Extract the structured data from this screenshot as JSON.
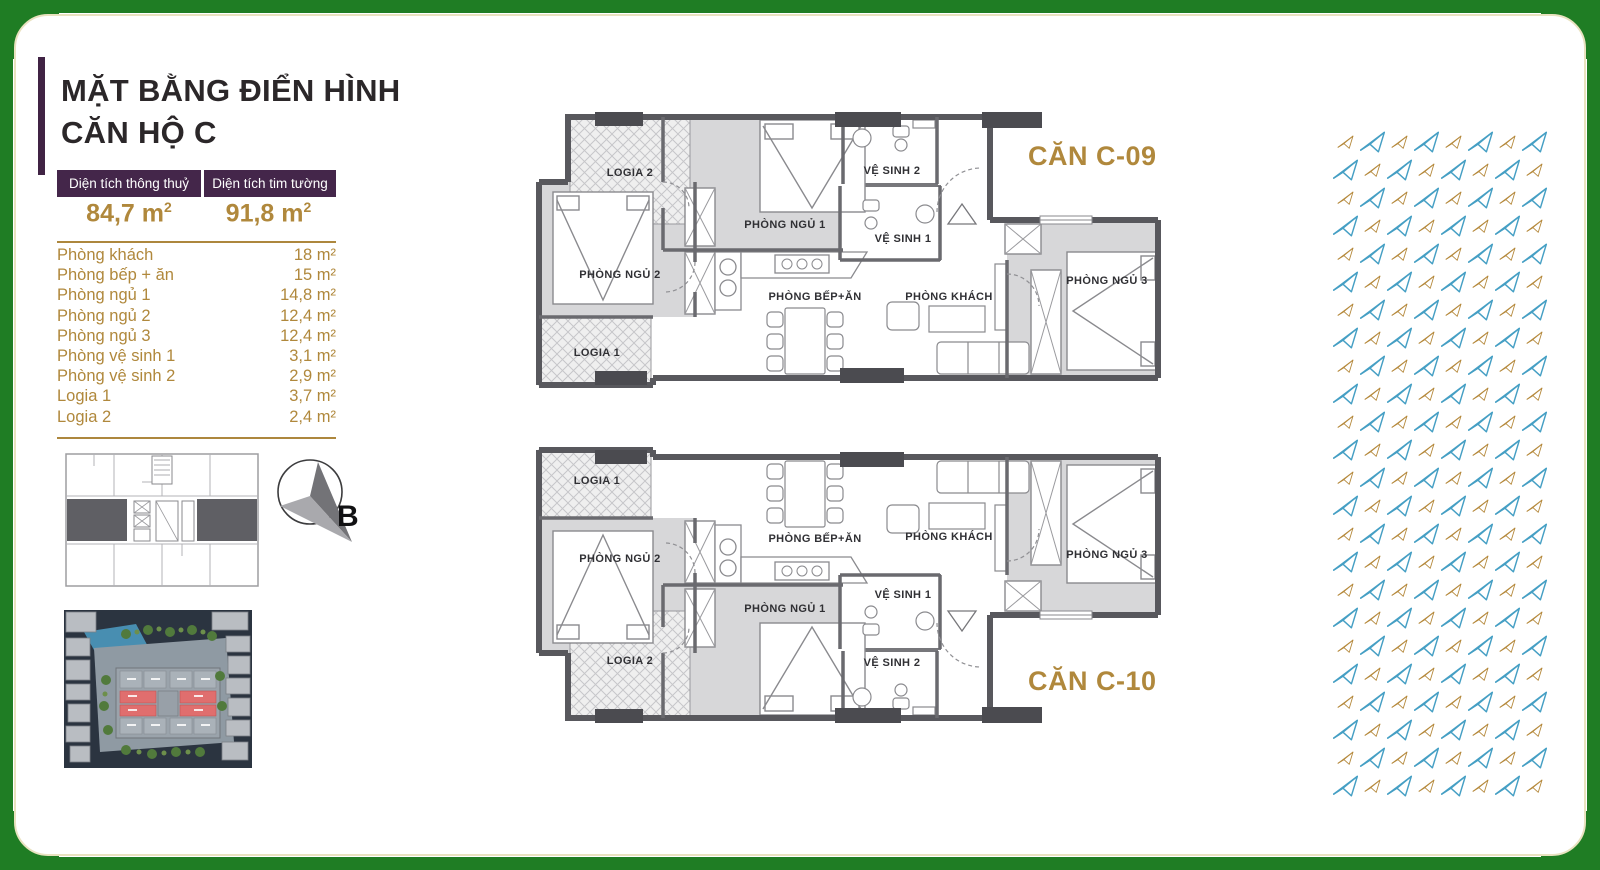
{
  "page": {
    "kind": "apartment floor plan brochure"
  },
  "colors": {
    "frame_green": "#1f7d24",
    "frame_cream": "#e9e2c0",
    "brand_purple": "#44264a",
    "brand_gold": "#b0883c",
    "plane_blue": "#459fc4",
    "plane_gold": "#b5893c",
    "highlight_red": "#e06e6e"
  },
  "sidebar": {
    "title_line1": "MẶT BẰNG ĐIỂN HÌNH",
    "title_line2": "CĂN HỘ C",
    "table": {
      "col1_header": "Diện tích thông thuỷ",
      "col2_header": "Diện tích tim tường",
      "col1_value": "84,7 m",
      "col1_sup": "2",
      "col2_value": "91,8 m",
      "col2_sup": "2"
    },
    "rooms": [
      {
        "name": "Phòng khách",
        "area": "18 m²"
      },
      {
        "name": "Phòng bếp + ăn",
        "area": "15 m²"
      },
      {
        "name": "Phòng ngủ 1",
        "area": "14,8 m²"
      },
      {
        "name": "Phòng ngủ 2",
        "area": "12,4 m²"
      },
      {
        "name": "Phòng ngủ 3",
        "area": "12,4 m²"
      },
      {
        "name": "Phòng vệ sinh 1",
        "area": "3,1 m²"
      },
      {
        "name": "Phòng vệ sinh 2",
        "area": "2,9 m²"
      },
      {
        "name": "Logia 1",
        "area": "3,7 m²"
      },
      {
        "name": "Logia 2",
        "area": "2,4 m²"
      }
    ]
  },
  "compass": {
    "label": "B"
  },
  "plans": {
    "c09": {
      "title": "CĂN C-09",
      "labels": {
        "logia2": "LOGIA 2",
        "bedroom1": "PHÒNG NGỦ 1",
        "bath2": "VỆ SINH 2",
        "bath1": "VỆ SINH 1",
        "bedroom2": "PHÒNG NGỦ 2",
        "logia1": "LOGIA 1",
        "kitchen": "PHÒNG BẾP+ĂN",
        "living": "PHÒNG KHÁCH",
        "bedroom3": "PHÒNG NGỦ 3"
      }
    },
    "c10": {
      "title": "CĂN C-10",
      "labels": {
        "logia1": "LOGIA 1",
        "bedroom2": "PHÒNG NGỦ 2",
        "logia2": "LOGIA 2",
        "kitchen": "PHÒNG BẾP+ĂN",
        "bedroom1": "PHÒNG NGỦ 1",
        "living": "PHÒNG KHÁCH",
        "bath1": "VỆ SINH 1",
        "bath2": "VỆ SINH 2",
        "bedroom3": "PHÒNG NGỦ 3"
      }
    }
  },
  "pattern": {
    "rows": 24,
    "cols": 8,
    "blue": "#459fc4",
    "gold": "#b5893c",
    "big": 27,
    "small": 17
  }
}
